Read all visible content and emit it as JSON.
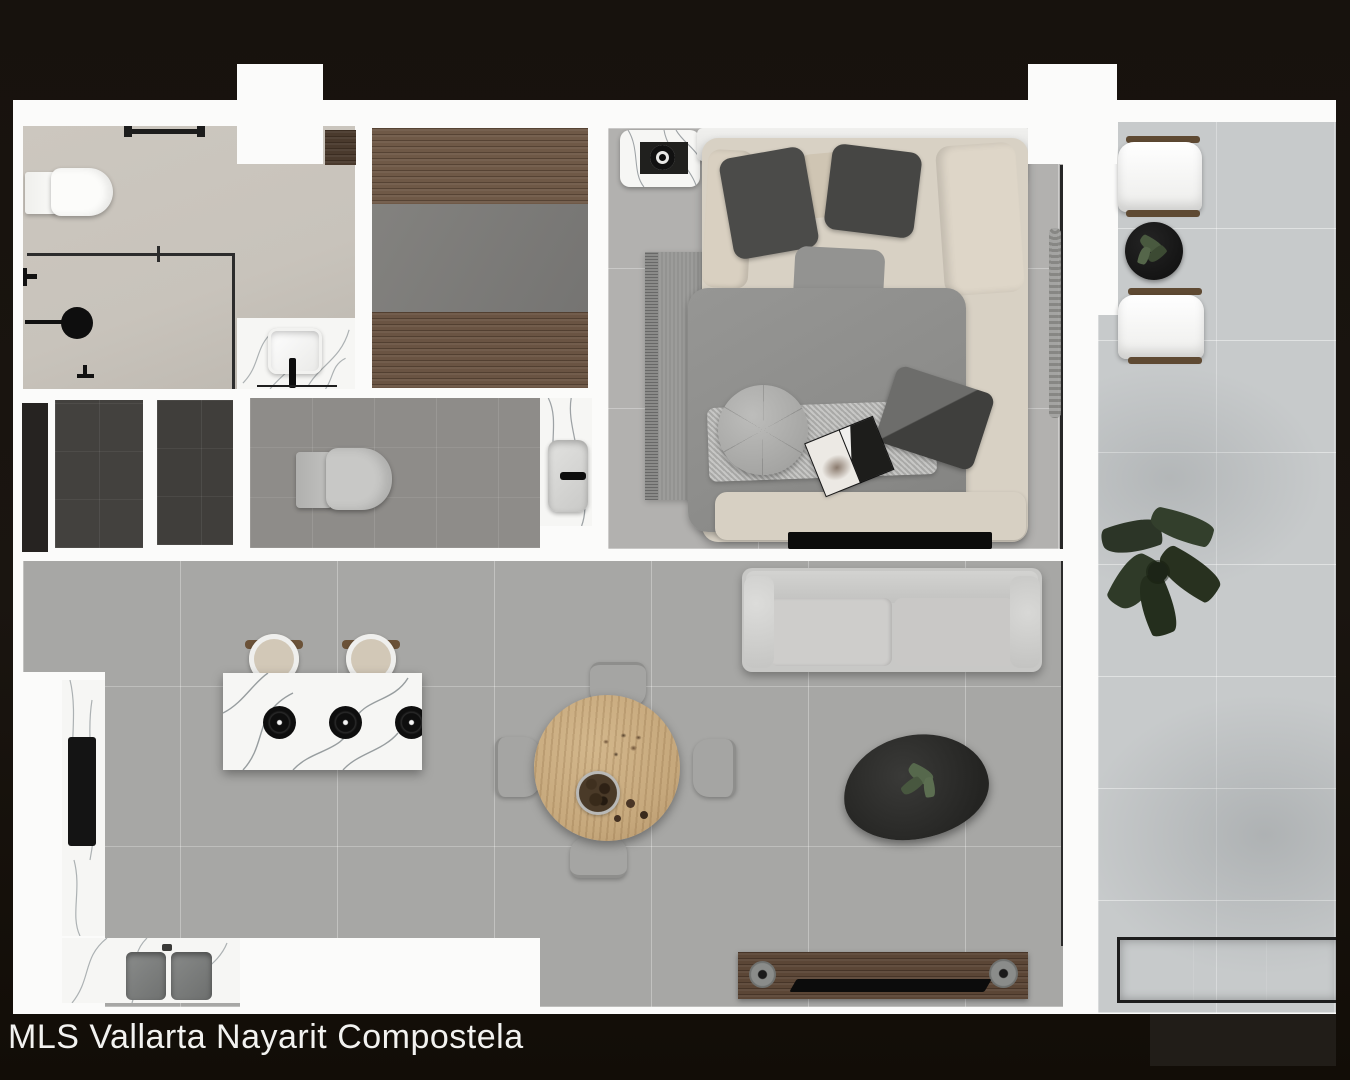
{
  "caption": {
    "text": "MLS Vallarta Nayarit Compostela"
  },
  "palette": {
    "bg_black": "#17120d",
    "wall_white": "#fbfbfa",
    "bathroom_floor": "#c8c3bb",
    "closet_wood": "#6f5947",
    "closet_gray": "#7d7c7a",
    "bedroom_floor": "#b2b1af",
    "living_floor": "#a7a7a5",
    "balcony_floor": "#c7cacb",
    "powder_floor": "#8e8c89",
    "utility_dark": "#43413e",
    "utility_column": "#262321",
    "marble": "#f6f6f4",
    "marble_vein": "#9aa0a3",
    "wood_console": "#5b4636",
    "wood_frame": "#6b5238",
    "tv_black": "#0c0c0c",
    "rug_gray": "#9c9c9a",
    "duvet_gray": "#8d8d8b",
    "throw_gray": "#b7b7b5",
    "cream": "#d8d1c4",
    "pillow_dark": "#4b4b49",
    "sofa_gray": "#c8c8c6",
    "chair_gray": "#a5a5a3",
    "table_wood": "#c6a87c",
    "plant_green": "#49593f",
    "plant_dark": "#2c3527",
    "sink_gray": "#7f8180",
    "fixture_black": "#1a1a1a",
    "caption_white": "#f2f2f0"
  }
}
